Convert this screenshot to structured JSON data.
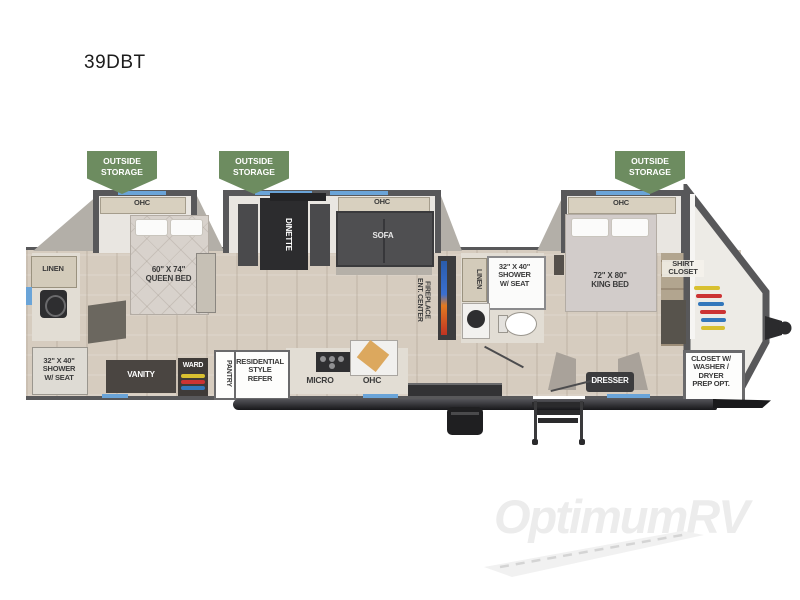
{
  "title": "39DBT",
  "watermark": "OptimumRV",
  "banner": "OUTSIDE\nSTORAGE",
  "labels": {
    "ohc": "OHC",
    "linen": "LINEN",
    "queen_bed": "60\" X 74\"\nQUEEN BED",
    "king_bed": "72\" X 80\"\nKING BED",
    "shower": "32\" X 40\"\nSHOWER\nW/ SEAT",
    "dinette": "DINETTE",
    "sofa": "SOFA",
    "ent_center": "ENT. CENTER\nFIREPLACE",
    "vanity": "VANITY",
    "ward": "WARD",
    "pantry": "PANTRY",
    "refer": "RESIDENTIAL\nSTYLE\nREFER",
    "micro": "MICRO",
    "dresser": "DRESSER",
    "shirt_closet": "SHIRT\nCLOSET",
    "washer_closet": "CLOSET W/\nWASHER /\nDRYER\nPREP OPT."
  },
  "colors": {
    "wall": "#58585a",
    "floor_tan": "#d6ccbf",
    "slide_floor": "#e9e6e1",
    "banner_green": "#6d8c60",
    "window_blue": "#6aa4d8",
    "cabinet_cream": "#d8d0bf",
    "dark_furniture": "#3c3c3e",
    "watermark_gray": "#ececec"
  }
}
